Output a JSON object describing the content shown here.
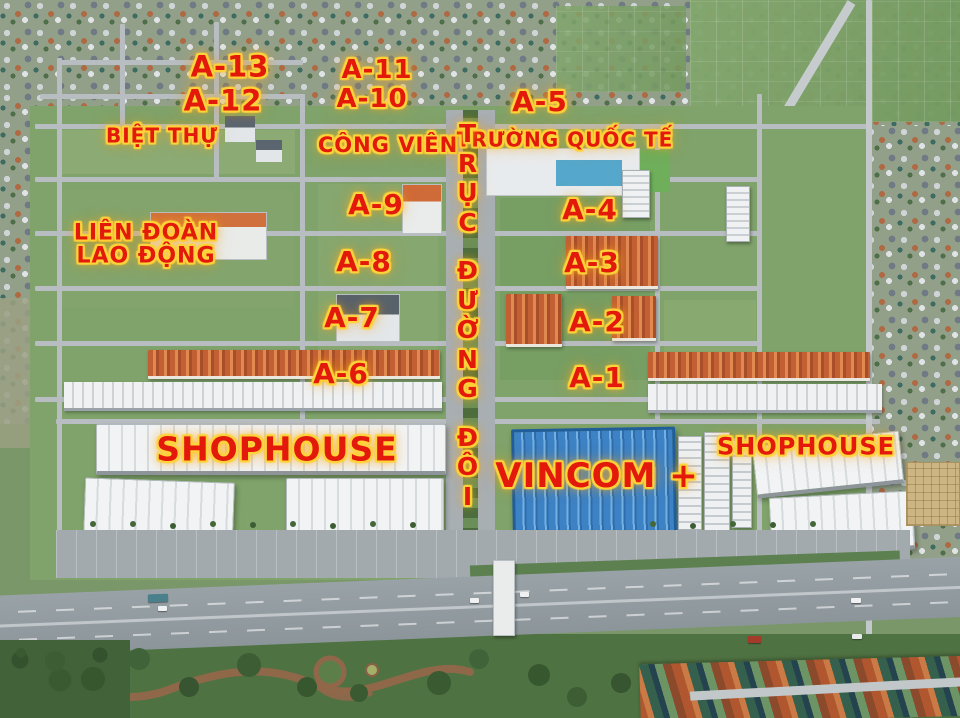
{
  "map": {
    "labels": [
      {
        "id": "a-13",
        "text": "A-13",
        "x": 230,
        "y": 67,
        "size": 29
      },
      {
        "id": "a-12",
        "text": "A-12",
        "x": 223,
        "y": 101,
        "size": 29
      },
      {
        "id": "biet-thu",
        "text": "BIỆT THỰ",
        "x": 162,
        "y": 136,
        "size": 20
      },
      {
        "id": "a-11",
        "text": "A-11",
        "x": 377,
        "y": 71,
        "size": 26
      },
      {
        "id": "a-10",
        "text": "A-10",
        "x": 372,
        "y": 100,
        "size": 26
      },
      {
        "id": "cong-vien",
        "text": "CÔNG VIÊN",
        "x": 388,
        "y": 145,
        "size": 21
      },
      {
        "id": "a-5",
        "text": "A-5",
        "x": 540,
        "y": 102,
        "size": 28
      },
      {
        "id": "truong-quoc-te",
        "text": "TRƯỜNG QUỐC TẾ",
        "x": 565,
        "y": 140,
        "size": 20
      },
      {
        "id": "lien-doan-lao-dong",
        "text": "LIÊN ĐOÀN\nLAO ĐỘNG",
        "x": 146,
        "y": 245,
        "size": 22
      },
      {
        "id": "a-9",
        "text": "A-9",
        "x": 376,
        "y": 205,
        "size": 28
      },
      {
        "id": "a-4",
        "text": "A-4",
        "x": 590,
        "y": 210,
        "size": 28
      },
      {
        "id": "a-8",
        "text": "A-8",
        "x": 364,
        "y": 262,
        "size": 28
      },
      {
        "id": "a-3",
        "text": "A-3",
        "x": 592,
        "y": 263,
        "size": 28
      },
      {
        "id": "a-7",
        "text": "A-7",
        "x": 352,
        "y": 318,
        "size": 28
      },
      {
        "id": "a-2",
        "text": "A-2",
        "x": 597,
        "y": 322,
        "size": 28
      },
      {
        "id": "a-6",
        "text": "A-6",
        "x": 341,
        "y": 374,
        "size": 28
      },
      {
        "id": "a-1",
        "text": "A-1",
        "x": 597,
        "y": 378,
        "size": 28
      },
      {
        "id": "truc-duong-doi",
        "text": "TRỤC ĐƯỜNG ĐÔI",
        "x": 468,
        "y": 315,
        "size": 25,
        "vertical": true
      },
      {
        "id": "shophouse-left",
        "text": "SHOPHOUSE",
        "x": 277,
        "y": 450,
        "size": 33
      },
      {
        "id": "vincom",
        "text": "VINCOM +",
        "x": 597,
        "y": 476,
        "size": 34
      },
      {
        "id": "shophouse-right",
        "text": "SHOPHOUSE",
        "x": 806,
        "y": 447,
        "size": 24
      }
    ]
  },
  "colors": {
    "label_text": "#e2190b",
    "label_glow": "#ffd33a",
    "vincom_roof": "#3e86c8",
    "orange_roof": "#c9653a",
    "grass": "#7a9769",
    "road": "#b4babd"
  }
}
